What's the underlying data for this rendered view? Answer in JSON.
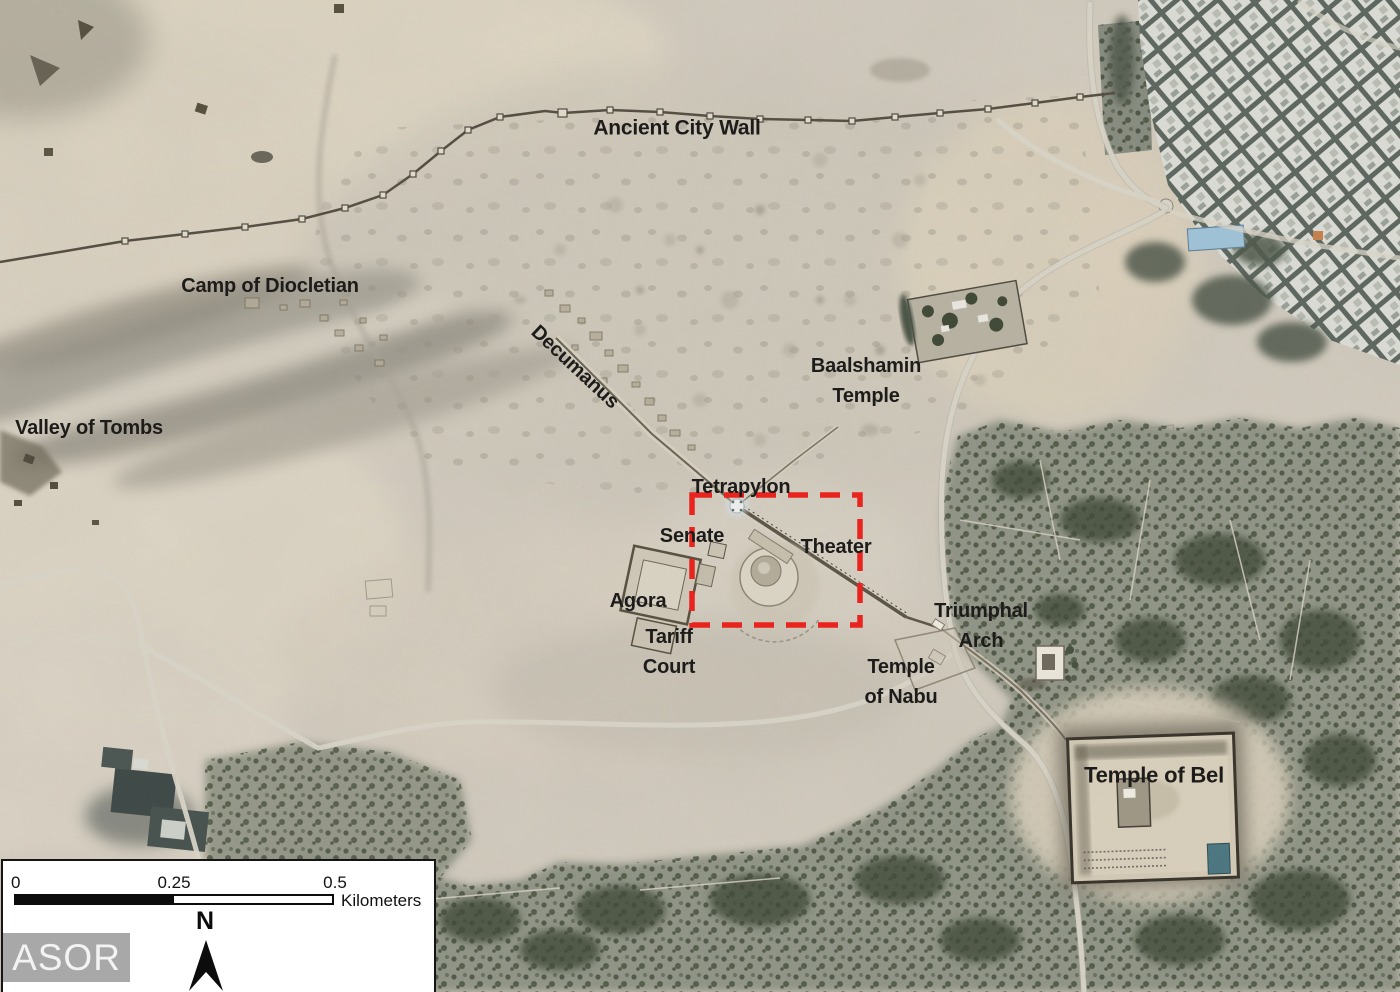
{
  "map_labels": [
    {
      "id": "ancient-city-wall",
      "lines": [
        "Ancient City Wall"
      ],
      "x": 677,
      "y": 128,
      "size": 21,
      "rotate": 0
    },
    {
      "id": "camp-of-diocletian",
      "lines": [
        "Camp of Diocletian"
      ],
      "x": 270,
      "y": 286,
      "size": 20,
      "rotate": 0
    },
    {
      "id": "valley-of-tombs",
      "lines": [
        "Valley of Tombs"
      ],
      "x": 89,
      "y": 428,
      "size": 20,
      "rotate": 0
    },
    {
      "id": "decumanus",
      "lines": [
        "Decumanus"
      ],
      "x": 575,
      "y": 367,
      "size": 20,
      "rotate": 43
    },
    {
      "id": "baalshamin-temple",
      "lines": [
        "Baalshamin",
        "Temple"
      ],
      "x": 866,
      "y": 381,
      "size": 20,
      "rotate": 0
    },
    {
      "id": "tetrapylon",
      "lines": [
        "Tetrapylon"
      ],
      "x": 741,
      "y": 487,
      "size": 20,
      "rotate": 0
    },
    {
      "id": "senate",
      "lines": [
        "Senate"
      ],
      "x": 692,
      "y": 536,
      "size": 20,
      "rotate": 0
    },
    {
      "id": "theater",
      "lines": [
        "Theater"
      ],
      "x": 836,
      "y": 547,
      "size": 20,
      "rotate": 0
    },
    {
      "id": "agora",
      "lines": [
        "Agora"
      ],
      "x": 638,
      "y": 601,
      "size": 20,
      "rotate": 0
    },
    {
      "id": "tariff-court",
      "lines": [
        "Tariff",
        "Court"
      ],
      "x": 669,
      "y": 652,
      "size": 20,
      "rotate": 0
    },
    {
      "id": "triumphal-arch",
      "lines": [
        "Triumphal",
        "Arch"
      ],
      "x": 981,
      "y": 626,
      "size": 20,
      "rotate": 0
    },
    {
      "id": "temple-of-nabu",
      "lines": [
        "Temple",
        "of Nabu"
      ],
      "x": 901,
      "y": 682,
      "size": 20,
      "rotate": 0
    },
    {
      "id": "temple-of-bel",
      "lines": [
        "Temple of Bel"
      ],
      "x": 1154,
      "y": 775,
      "size": 22,
      "rotate": 0
    }
  ],
  "highlight_box": {
    "x": 692,
    "y": 495,
    "width": 168,
    "height": 130,
    "color": "#e9231d"
  },
  "scale_bar": {
    "ticks": [
      "0",
      "0.25",
      "0.5"
    ],
    "unit": "Kilometers"
  },
  "north_arrow": {
    "label": "N"
  },
  "watermark": {
    "text": "ASOR"
  },
  "label_color": "#1d1c1a"
}
